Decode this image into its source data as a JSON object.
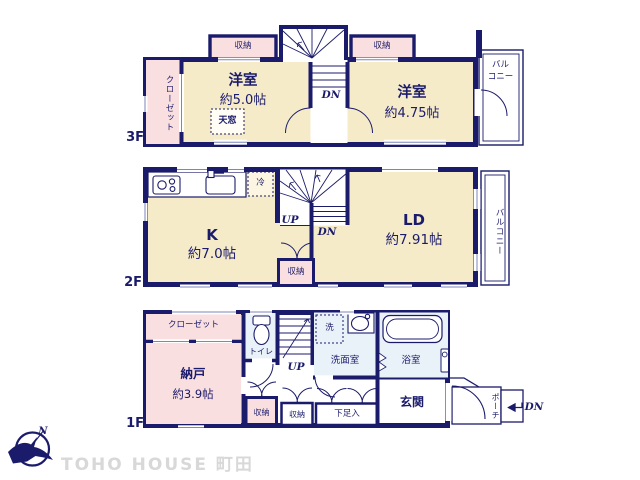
{
  "colors": {
    "wall_navy": "#1b1b6b",
    "room_cream": "#f5ebc9",
    "room_pink": "#f9dfdf",
    "wet_blue": "#e9f1f9",
    "logo_gray": "#d8d8d8"
  },
  "compass": {
    "north": "N"
  },
  "brand": {
    "logo": "TOHO HOUSE 町田"
  },
  "floor3": {
    "label": "3F",
    "closet": "クローゼット",
    "storage_left": "収納",
    "storage_right": "収納",
    "room_left_name": "洋室",
    "room_left_size": "約5.0帖",
    "skylight": "天窓",
    "stairs_dn": "DN",
    "room_right_name": "洋室",
    "room_right_size": "約4.75帖",
    "balcony_line1": "バル",
    "balcony_line2": "コニー"
  },
  "floor2": {
    "label": "2F",
    "kitchen_name": "K",
    "kitchen_size": "約7.0帖",
    "fridge": "冷",
    "stairs_up": "UP",
    "stairs_dn": "DN",
    "storage": "収納",
    "living_name": "LD",
    "living_size": "約7.91帖",
    "balcony": "バルコニー"
  },
  "floor1": {
    "label": "1F",
    "closet": "クローゼット",
    "storeroom_name": "納戸",
    "storeroom_size": "約3.9帖",
    "toilet": "トイレ",
    "stairs_up": "UP",
    "laundry": "洗",
    "washroom": "洗面室",
    "bathroom": "浴室",
    "storage_small": "収納",
    "storage_hall": "収納",
    "shoe_cabinet": "下足入",
    "entrance": "玄関",
    "porch": "ポーチ",
    "exit_dn": "DN"
  }
}
